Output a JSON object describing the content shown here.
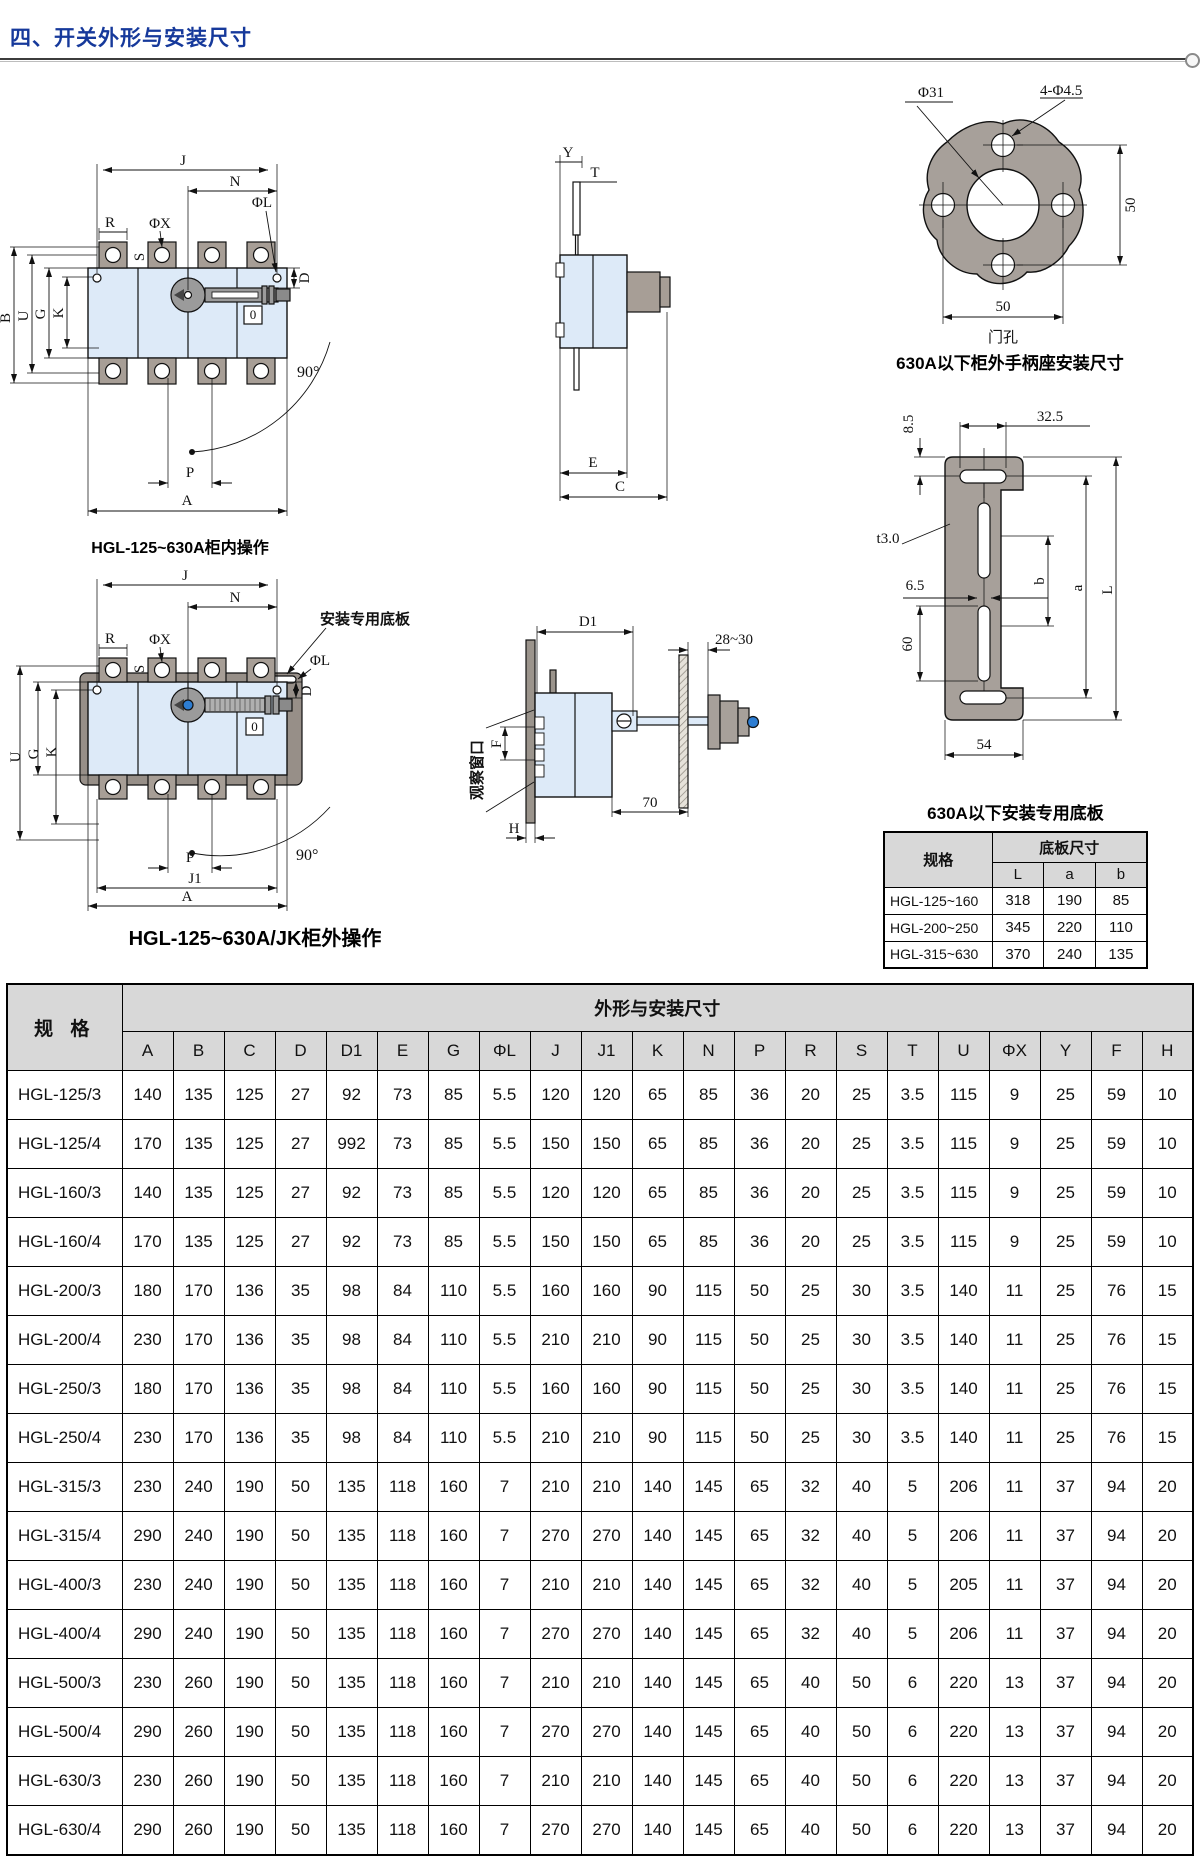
{
  "page": {
    "title": "四、开关外形与安装尺寸"
  },
  "colors": {
    "accent_blue": "#16399b",
    "body_fill": "#ddeaf8",
    "metal_gray": "#a7a09a",
    "handle_blue": "#2d7dd2",
    "table_header_gray": "#d8d8d8"
  },
  "captions": {
    "d1": "HGL-125~630A柜内操作",
    "d3": "630A以下柜外手柄座安装尺寸",
    "d5": "HGL-125~630A/JK柜外操作"
  },
  "d1": {
    "labels": {
      "j": "J",
      "n": "N",
      "r": "R",
      "phix": "ΦX",
      "s": "S",
      "phil": "ΦL",
      "d": "D",
      "b": "B",
      "u": "U",
      "g": "G",
      "k": "K",
      "zero": "0",
      "angle": "90°",
      "p": "P",
      "a": "A"
    }
  },
  "d2": {
    "labels": {
      "y": "Y",
      "t": "T",
      "e": "E",
      "c": "C"
    }
  },
  "d3": {
    "labels": {
      "phi31": "Φ31",
      "holes": "4-Φ4.5",
      "v50": "50",
      "h50": "50",
      "door": "门孔"
    }
  },
  "d4": {
    "labels": {
      "d85": "8.5",
      "d325": "32.5",
      "t3": "t3.0",
      "d65": "6.5",
      "d60": "60",
      "b": "b",
      "a": "a",
      "l": "L",
      "d54": "54"
    }
  },
  "d5": {
    "labels": {
      "j": "J",
      "n": "N",
      "r": "R",
      "phix": "ΦX",
      "s": "S",
      "plate": "安装专用底板",
      "phil": "ΦL",
      "d": "D",
      "u": "U",
      "g": "G",
      "k": "K",
      "zero": "0",
      "angle": "90°",
      "p": "P",
      "j1": "J1",
      "a": "A"
    }
  },
  "d6": {
    "labels": {
      "d1": "D1",
      "gap": "28~30",
      "window": "观察窗口",
      "f": "F",
      "h": "H",
      "d70": "70"
    }
  },
  "plate_table": {
    "title": "630A以下安装专用底板",
    "col_spec": "规格",
    "col_size": "底板尺寸",
    "cols": [
      "L",
      "a",
      "b"
    ],
    "rows": [
      [
        "HGL-125~160",
        "318",
        "190",
        "85"
      ],
      [
        "HGL-200~250",
        "345",
        "220",
        "110"
      ],
      [
        "HGL-315~630",
        "370",
        "240",
        "135"
      ]
    ]
  },
  "main_table": {
    "col_spec": "规 格",
    "col_dims": "外形与安装尺寸",
    "columns": [
      "A",
      "B",
      "C",
      "D",
      "D1",
      "E",
      "G",
      "ΦL",
      "J",
      "J1",
      "K",
      "N",
      "P",
      "R",
      "S",
      "T",
      "U",
      "ΦX",
      "Y",
      "F",
      "H"
    ],
    "rows": [
      [
        "HGL-125/3",
        "140",
        "135",
        "125",
        "27",
        "92",
        "73",
        "85",
        "5.5",
        "120",
        "120",
        "65",
        "85",
        "36",
        "20",
        "25",
        "3.5",
        "115",
        "9",
        "25",
        "59",
        "10"
      ],
      [
        "HGL-125/4",
        "170",
        "135",
        "125",
        "27",
        "992",
        "73",
        "85",
        "5.5",
        "150",
        "150",
        "65",
        "85",
        "36",
        "20",
        "25",
        "3.5",
        "115",
        "9",
        "25",
        "59",
        "10"
      ],
      [
        "HGL-160/3",
        "140",
        "135",
        "125",
        "27",
        "92",
        "73",
        "85",
        "5.5",
        "120",
        "120",
        "65",
        "85",
        "36",
        "20",
        "25",
        "3.5",
        "115",
        "9",
        "25",
        "59",
        "10"
      ],
      [
        "HGL-160/4",
        "170",
        "135",
        "125",
        "27",
        "92",
        "73",
        "85",
        "5.5",
        "150",
        "150",
        "65",
        "85",
        "36",
        "20",
        "25",
        "3.5",
        "115",
        "9",
        "25",
        "59",
        "10"
      ],
      [
        "HGL-200/3",
        "180",
        "170",
        "136",
        "35",
        "98",
        "84",
        "110",
        "5.5",
        "160",
        "160",
        "90",
        "115",
        "50",
        "25",
        "30",
        "3.5",
        "140",
        "11",
        "25",
        "76",
        "15"
      ],
      [
        "HGL-200/4",
        "230",
        "170",
        "136",
        "35",
        "98",
        "84",
        "110",
        "5.5",
        "210",
        "210",
        "90",
        "115",
        "50",
        "25",
        "30",
        "3.5",
        "140",
        "11",
        "25",
        "76",
        "15"
      ],
      [
        "HGL-250/3",
        "180",
        "170",
        "136",
        "35",
        "98",
        "84",
        "110",
        "5.5",
        "160",
        "160",
        "90",
        "115",
        "50",
        "25",
        "30",
        "3.5",
        "140",
        "11",
        "25",
        "76",
        "15"
      ],
      [
        "HGL-250/4",
        "230",
        "170",
        "136",
        "35",
        "98",
        "84",
        "110",
        "5.5",
        "210",
        "210",
        "90",
        "115",
        "50",
        "25",
        "30",
        "3.5",
        "140",
        "11",
        "25",
        "76",
        "15"
      ],
      [
        "HGL-315/3",
        "230",
        "240",
        "190",
        "50",
        "135",
        "118",
        "160",
        "7",
        "210",
        "210",
        "140",
        "145",
        "65",
        "32",
        "40",
        "5",
        "206",
        "11",
        "37",
        "94",
        "20"
      ],
      [
        "HGL-315/4",
        "290",
        "240",
        "190",
        "50",
        "135",
        "118",
        "160",
        "7",
        "270",
        "270",
        "140",
        "145",
        "65",
        "32",
        "40",
        "5",
        "206",
        "11",
        "37",
        "94",
        "20"
      ],
      [
        "HGL-400/3",
        "230",
        "240",
        "190",
        "50",
        "135",
        "118",
        "160",
        "7",
        "210",
        "210",
        "140",
        "145",
        "65",
        "32",
        "40",
        "5",
        "205",
        "11",
        "37",
        "94",
        "20"
      ],
      [
        "HGL-400/4",
        "290",
        "240",
        "190",
        "50",
        "135",
        "118",
        "160",
        "7",
        "270",
        "270",
        "140",
        "145",
        "65",
        "32",
        "40",
        "5",
        "206",
        "11",
        "37",
        "94",
        "20"
      ],
      [
        "HGL-500/3",
        "230",
        "260",
        "190",
        "50",
        "135",
        "118",
        "160",
        "7",
        "210",
        "210",
        "140",
        "145",
        "65",
        "40",
        "50",
        "6",
        "220",
        "13",
        "37",
        "94",
        "20"
      ],
      [
        "HGL-500/4",
        "290",
        "260",
        "190",
        "50",
        "135",
        "118",
        "160",
        "7",
        "270",
        "270",
        "140",
        "145",
        "65",
        "40",
        "50",
        "6",
        "220",
        "13",
        "37",
        "94",
        "20"
      ],
      [
        "HGL-630/3",
        "230",
        "260",
        "190",
        "50",
        "135",
        "118",
        "160",
        "7",
        "210",
        "210",
        "140",
        "145",
        "65",
        "40",
        "50",
        "6",
        "220",
        "13",
        "37",
        "94",
        "20"
      ],
      [
        "HGL-630/4",
        "290",
        "260",
        "190",
        "50",
        "135",
        "118",
        "160",
        "7",
        "270",
        "270",
        "140",
        "145",
        "65",
        "40",
        "50",
        "6",
        "220",
        "13",
        "37",
        "94",
        "20"
      ]
    ]
  }
}
